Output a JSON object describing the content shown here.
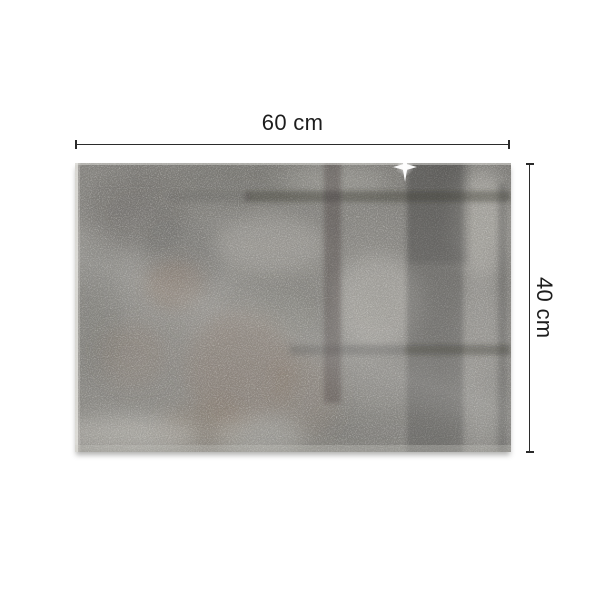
{
  "colors": {
    "background": "#ffffff",
    "line": "#2b2b2b",
    "label": "#1d1d1d",
    "board-base": "#8c8a85",
    "board-dark": "#595854",
    "board-rust": "#8a6b52",
    "board-light": "#dbd9d2",
    "reflection": "#34332f",
    "sparkle": "#ffffff"
  },
  "dimensions": {
    "width_label": "60 cm",
    "height_label": "40 cm"
  },
  "icons": {
    "sparkle": "sparkle-icon"
  }
}
